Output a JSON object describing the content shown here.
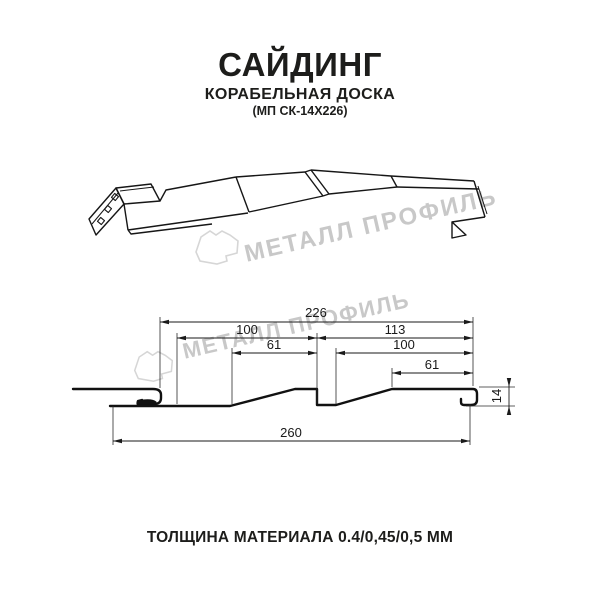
{
  "header": {
    "title": "САЙДИНГ",
    "subtitle": "КОРАБЕЛЬНАЯ ДОСКА",
    "code": "(МП СК-14Х226)"
  },
  "watermark": {
    "brand": "МЕТАЛЛ ПРОФИЛЬ",
    "logo_icon": "metall-profil-logo",
    "text_color": "#c8c8c8",
    "logo_color": "#d6d6d6"
  },
  "section_drawing": {
    "dimensions": {
      "visible_width": "226",
      "left_pitch": "100",
      "left_flat": "61",
      "right_span": "113",
      "right_pitch": "100",
      "right_flat": "61",
      "total_width": "260",
      "profile_height": "14"
    }
  },
  "footer": {
    "thickness_note": "ТОЛЩИНА МАТЕРИАЛА 0.4/0,45/0,5 ММ"
  },
  "colors": {
    "line": "#1a1a1a",
    "text": "#1d1d1b",
    "watermark": "#c8c8c8"
  }
}
